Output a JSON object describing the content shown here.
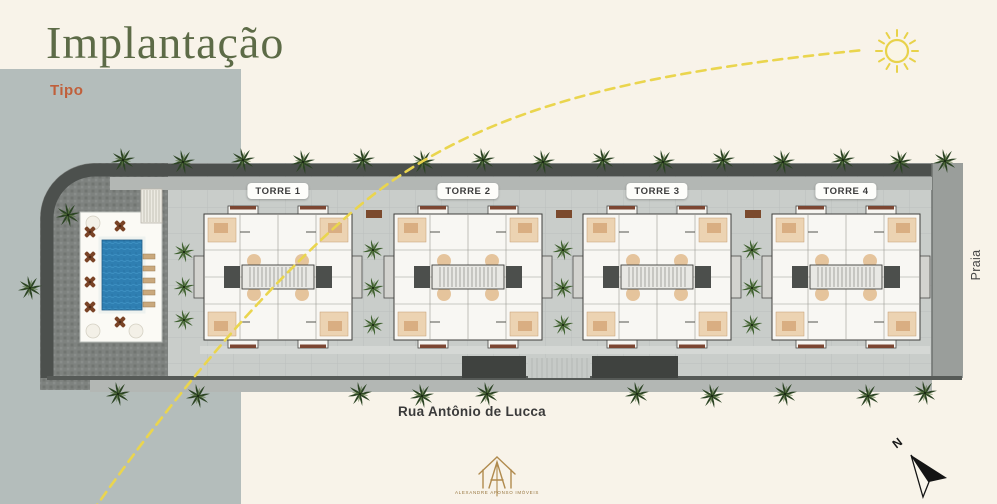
{
  "header": {
    "title": "Implantação",
    "subtitle": "Tipo"
  },
  "site_plan": {
    "tower_labels": [
      "TORRE 1",
      "TORRE 2",
      "TORRE 3",
      "TORRE 4"
    ],
    "street_bottom": "Rua Antônio de Lucca",
    "street_right": "Praia"
  },
  "compass": {
    "north": "N"
  },
  "branding": {
    "caption": "ALEXANDRE AFONSO IMÓVEIS"
  },
  "palette": {
    "background": "#f8f3e9",
    "side_panel": "#b4bdbb",
    "title_green": "#5d6b47",
    "subtitle_orange": "#c05f3a",
    "sun_path_yellow": "#ead54e",
    "pool_blue": "#2f7fb2",
    "road_dark": "#4c504d",
    "paving_gray": "#c9cdca"
  }
}
